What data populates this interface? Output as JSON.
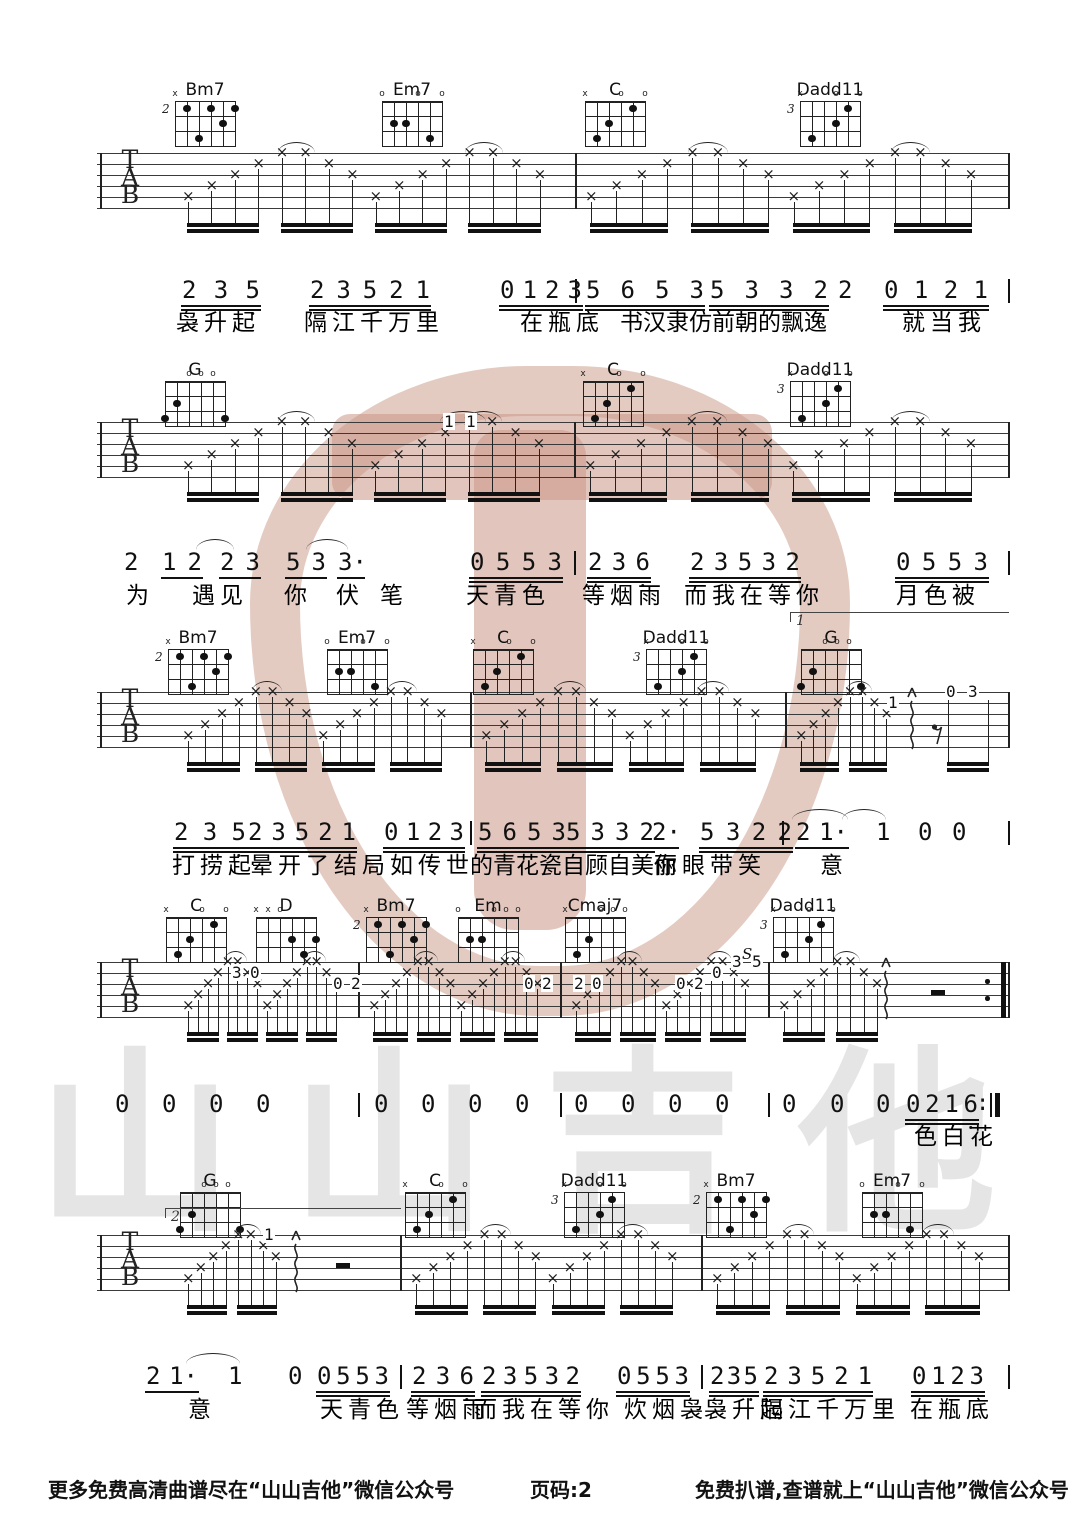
{
  "page": {
    "width": 1080,
    "height": 1527
  },
  "watermark": {
    "text": "山山吉他",
    "text_color": "#e5e5e5",
    "pick_color": "#ca9886"
  },
  "tab_letters": [
    "T",
    "A",
    "B"
  ],
  "footer": {
    "left": "更多免费高清曲谱尽在“山山吉他”微信公众号",
    "center": "页码:2",
    "right": "免费扒谱,查谱就上“山山吉他”微信公众号"
  },
  "chord_shapes": {
    "Bm7": {
      "base": "2",
      "markers": [
        "x",
        "",
        "",
        "",
        "",
        ""
      ],
      "dots": [
        [
          2,
          1
        ],
        [
          4,
          1
        ],
        [
          6,
          1
        ],
        [
          5,
          2
        ],
        [
          3,
          3
        ]
      ]
    },
    "Em7": {
      "base": "",
      "markers": [
        "o",
        "",
        "",
        "o",
        "",
        "o"
      ],
      "dots": [
        [
          2,
          2
        ],
        [
          3,
          2
        ],
        [
          5,
          3
        ]
      ]
    },
    "C": {
      "base": "",
      "markers": [
        "x",
        "",
        "",
        "o",
        "",
        "o"
      ],
      "dots": [
        [
          5,
          1
        ],
        [
          3,
          2
        ],
        [
          2,
          3
        ]
      ]
    },
    "Dadd11": {
      "base": "3",
      "markers": [
        "x",
        "",
        "",
        "o",
        "",
        "o"
      ],
      "dots": [
        [
          5,
          1
        ],
        [
          4,
          2
        ],
        [
          2,
          3
        ]
      ]
    },
    "G": {
      "base": "",
      "markers": [
        "",
        "",
        "o",
        "o",
        "o",
        ""
      ],
      "dots": [
        [
          2,
          2
        ],
        [
          1,
          3
        ],
        [
          6,
          3
        ]
      ]
    },
    "D": {
      "base": "",
      "markers": [
        "x",
        "x",
        "o",
        "",
        "",
        ""
      ],
      "dots": [
        [
          4,
          2
        ],
        [
          6,
          2
        ],
        [
          5,
          3
        ]
      ]
    },
    "Em": {
      "base": "",
      "markers": [
        "o",
        "",
        "",
        "o",
        "o",
        "o"
      ],
      "dots": [
        [
          2,
          2
        ],
        [
          3,
          2
        ]
      ]
    },
    "Cmaj7": {
      "base": "",
      "markers": [
        "x",
        "",
        "",
        "o",
        "o",
        "o"
      ],
      "dots": [
        [
          3,
          2
        ],
        [
          2,
          3
        ]
      ]
    }
  },
  "voltas": [
    {
      "x1": 790,
      "x2": 1008,
      "y": 612,
      "label": "1"
    },
    {
      "x1": 165,
      "x2": 400,
      "y": 1208,
      "label": "2"
    }
  ],
  "systems": [
    {
      "staff_top": 153,
      "chord_y": 84,
      "measures": [
        [
          100,
          575,
          "full"
        ],
        [
          575,
          1008,
          "full"
        ]
      ],
      "chords": [
        {
          "name": "Bm7",
          "x": 205
        },
        {
          "name": "Em7",
          "x": 412
        },
        {
          "name": "C",
          "x": 615
        },
        {
          "name": "Dadd11",
          "x": 830
        }
      ],
      "overlays": [],
      "squiggles": [],
      "rests": [],
      "staff_arcs": [],
      "end": "bar",
      "melody": {
        "y": 276,
        "barlines": [
          575,
          1008
        ],
        "groups": [
          [
            182,
            78,
            "235_",
            2
          ],
          [
            310,
            120,
            "23521",
            2
          ],
          [
            500,
            82,
            "0123",
            2
          ],
          [
            586,
            118,
            "5653",
            2
          ],
          [
            710,
            118,
            "5332",
            2
          ],
          [
            838,
            14,
            "2",
            0
          ],
          [
            884,
            104,
            "0121",
            2
          ]
        ],
        "arcs": []
      },
      "lyrics": {
        "y": 310,
        "segs": [
          [
            176,
            "袅升起",
            0
          ],
          [
            304,
            "隔江千万里",
            0
          ],
          [
            520,
            "在瓶底",
            0
          ],
          [
            620,
            "书汉隶仿前朝的飘逸",
            1
          ],
          [
            902,
            "就当我",
            0
          ]
        ]
      }
    },
    {
      "staff_top": 422,
      "chord_y": 364,
      "measures": [
        [
          100,
          574,
          "full"
        ],
        [
          574,
          1008,
          "full"
        ]
      ],
      "chords": [
        {
          "name": "G",
          "x": 195
        },
        {
          "name": "C",
          "x": 613
        },
        {
          "name": "Dadd11",
          "x": 820
        }
      ],
      "overlays": [
        [
          448,
          1,
          "1"
        ],
        [
          470,
          1,
          "1"
        ]
      ],
      "squiggles": [],
      "rests": [],
      "staff_arcs": [
        [
          440,
          486
        ]
      ],
      "end": "bar",
      "melody": {
        "y": 548,
        "barlines": [
          574,
          1008
        ],
        "groups": [
          [
            124,
            14,
            "2",
            0
          ],
          [
            162,
            40,
            "12",
            1
          ],
          [
            220,
            40,
            "23",
            1
          ],
          [
            286,
            40,
            "53",
            1
          ],
          [
            338,
            26,
            "3.",
            1
          ],
          [
            470,
            92,
            "0553",
            2
          ],
          [
            588,
            62,
            "236_",
            2
          ],
          [
            690,
            110,
            "23532",
            2
          ],
          [
            896,
            92,
            "0553",
            2
          ]
        ],
        "arcs": [
          [
            196,
            234
          ],
          [
            306,
            348
          ]
        ]
      },
      "lyrics": {
        "y": 583,
        "segs": [
          [
            126,
            "为",
            0
          ],
          [
            192,
            "遇见",
            0
          ],
          [
            284,
            "你",
            0
          ],
          [
            336,
            "伏",
            0
          ],
          [
            380,
            "笔",
            0
          ],
          [
            466,
            "天青色",
            0
          ],
          [
            582,
            "等烟雨",
            0
          ],
          [
            684,
            "而我在等你",
            0
          ],
          [
            896,
            "月色被",
            0
          ]
        ]
      }
    },
    {
      "staff_top": 692,
      "chord_y": 632,
      "measures": [
        [
          100,
          470,
          "full"
        ],
        [
          470,
          785,
          "full"
        ],
        [
          785,
          1008,
          "half"
        ]
      ],
      "chords": [
        {
          "name": "Bm7",
          "x": 198
        },
        {
          "name": "Em7",
          "x": 357
        },
        {
          "name": "C",
          "x": 503
        },
        {
          "name": "Dadd11",
          "x": 676
        },
        {
          "name": "G",
          "x": 831
        }
      ],
      "overlays": [
        [
          892,
          2,
          "1"
        ],
        [
          950,
          1,
          "0"
        ],
        [
          972,
          1,
          "3"
        ]
      ],
      "squiggles": [
        912
      ],
      "rests": [
        [
          936,
          "eighth"
        ]
      ],
      "staff_arcs": [],
      "minibeam": [
        948,
        988
      ],
      "end": "bar",
      "melody": {
        "y": 818,
        "barlines": [
          470,
          782,
          1008
        ],
        "groups": [
          [
            174,
            72,
            "235_",
            2
          ],
          [
            248,
            108,
            "23521",
            2
          ],
          [
            384,
            80,
            "0123",
            2
          ],
          [
            478,
            88,
            "5653",
            2
          ],
          [
            566,
            88,
            "5332",
            2
          ],
          [
            652,
            26,
            "2.",
            1
          ],
          [
            700,
            92,
            "5322",
            2
          ],
          [
            796,
            52,
            "21.",
            1
          ],
          [
            876,
            14,
            "1",
            0
          ],
          [
            918,
            14,
            "0",
            0
          ],
          [
            952,
            14,
            "0",
            0
          ]
        ],
        "arcs": [
          [
            792,
            848
          ],
          [
            842,
            886
          ]
        ]
      },
      "lyrics": {
        "y": 853,
        "segs": [
          [
            172,
            "打捞起",
            0
          ],
          [
            250,
            "晕开了结局",
            0
          ],
          [
            390,
            "如传世",
            0
          ],
          [
            470,
            "的青花瓷自顾自美丽",
            1
          ],
          [
            654,
            "你眼",
            0
          ],
          [
            710,
            "带笑",
            0
          ],
          [
            820,
            "意",
            0
          ]
        ]
      }
    },
    {
      "staff_top": 962,
      "chord_y": 900,
      "measures": [
        [
          100,
          358,
          "full"
        ],
        [
          358,
          560,
          "full"
        ],
        [
          560,
          768,
          "full"
        ],
        [
          768,
          1008,
          "half"
        ]
      ],
      "chords": [
        {
          "name": "C",
          "x": 196
        },
        {
          "name": "D",
          "x": 286
        },
        {
          "name": "Bm7",
          "x": 396
        },
        {
          "name": "Em",
          "x": 488
        },
        {
          "name": "Cmaj7",
          "x": 595
        },
        {
          "name": "Dadd11",
          "x": 803
        }
      ],
      "overlays": [
        [
          236,
          2,
          "3"
        ],
        [
          254,
          2,
          "0"
        ],
        [
          337,
          3,
          "0"
        ],
        [
          355,
          3,
          "2"
        ],
        [
          528,
          3,
          "0"
        ],
        [
          546,
          3,
          "2"
        ],
        [
          578,
          3,
          "2"
        ],
        [
          596,
          3,
          "0"
        ],
        [
          680,
          3,
          "0"
        ],
        [
          698,
          3,
          "2"
        ],
        [
          716,
          2,
          "0"
        ],
        [
          736,
          1,
          "3"
        ],
        [
          756,
          1,
          "5"
        ],
        [
          747,
          0,
          "S"
        ]
      ],
      "squiggles": [
        886
      ],
      "rests": [
        [
          938,
          "half"
        ]
      ],
      "staff_arcs": [],
      "end": "repeat",
      "melody": {
        "y": 1090,
        "barlines": [
          358,
          560,
          768
        ],
        "repeat_end": true,
        "groups": [
          [
            115,
            14,
            "0",
            0
          ],
          [
            162,
            14,
            "0",
            0
          ],
          [
            209,
            14,
            "0",
            0
          ],
          [
            256,
            14,
            "0",
            0
          ],
          [
            374,
            14,
            "0",
            0
          ],
          [
            421,
            14,
            "0",
            0
          ],
          [
            468,
            14,
            "0",
            0
          ],
          [
            515,
            14,
            "0",
            0
          ],
          [
            574,
            14,
            "0",
            0
          ],
          [
            621,
            14,
            "0",
            0
          ],
          [
            668,
            14,
            "0",
            0
          ],
          [
            715,
            14,
            "0",
            0
          ],
          [
            782,
            14,
            "0",
            0
          ],
          [
            830,
            14,
            "0",
            0
          ],
          [
            876,
            14,
            "0",
            0
          ],
          [
            906,
            72,
            "0216_",
            2
          ]
        ],
        "arcs": []
      },
      "lyrics": {
        "y": 1124,
        "segs": [
          [
            914,
            "色白花",
            0
          ]
        ]
      }
    },
    {
      "staff_top": 1235,
      "chord_y": 1175,
      "measures": [
        [
          100,
          400,
          "half"
        ],
        [
          400,
          701,
          "full"
        ],
        [
          701,
          1008,
          "full"
        ]
      ],
      "chords": [
        {
          "name": "G",
          "x": 210
        },
        {
          "name": "C",
          "x": 435
        },
        {
          "name": "Dadd11",
          "x": 594
        },
        {
          "name": "Bm7",
          "x": 736
        },
        {
          "name": "Em7",
          "x": 892
        }
      ],
      "overlays": [
        [
          268,
          1,
          "1"
        ]
      ],
      "squiggles": [
        296
      ],
      "rests": [
        [
          343,
          "half"
        ]
      ],
      "staff_arcs": [],
      "end": "bar",
      "melody": {
        "y": 1362,
        "barlines": [
          400,
          701,
          1008
        ],
        "groups": [
          [
            146,
            52,
            "21.",
            1
          ],
          [
            228,
            14,
            "1",
            0
          ],
          [
            288,
            14,
            "0",
            0
          ],
          [
            317,
            72,
            "0553",
            2
          ],
          [
            412,
            62,
            "236_",
            2
          ],
          [
            482,
            98,
            "23532",
            2
          ],
          [
            617,
            72,
            "0553",
            2
          ],
          [
            710,
            48,
            "235_",
            2
          ],
          [
            764,
            108,
            "23521",
            2
          ],
          [
            912,
            72,
            "0123",
            2
          ]
        ],
        "arcs": [
          [
            186,
            240
          ]
        ]
      },
      "lyrics": {
        "y": 1397,
        "segs": [
          [
            188,
            "意",
            0
          ],
          [
            320,
            "天青色",
            0
          ],
          [
            406,
            "等烟雨",
            0
          ],
          [
            474,
            "而我在等你",
            0
          ],
          [
            624,
            "炊烟袅",
            0
          ],
          [
            704,
            "袅升起",
            0
          ],
          [
            760,
            "隔江千万里",
            0
          ],
          [
            910,
            "在瓶底",
            0
          ]
        ]
      }
    }
  ]
}
